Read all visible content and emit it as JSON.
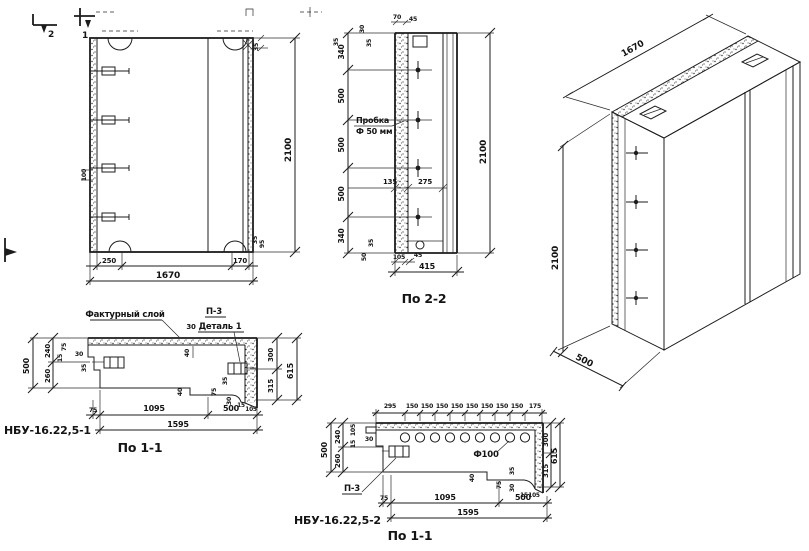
{
  "colors": {
    "ink": "#1c1c1c",
    "paper": "#ffffff"
  },
  "elevation": {
    "cut_marks": [
      "2",
      "1"
    ],
    "dim_top": "35",
    "dim_anchor": "100",
    "side_small": [
      "35",
      "95"
    ],
    "height": "2100",
    "bottom_left": "250",
    "bottom_right": "170",
    "bottom_total": "1670"
  },
  "section_2_2": {
    "label": "По 2-2",
    "plug_label": [
      "Пробка",
      "Ф 50 мм"
    ],
    "top_small": [
      "70",
      "45"
    ],
    "side_small": [
      "30",
      "35"
    ],
    "left_chain": [
      "340",
      "500",
      "500",
      "500",
      "340"
    ],
    "edge_top": "35",
    "edge_bottom": "35",
    "edge_50": "50",
    "mid": [
      "135",
      "275"
    ],
    "bottom_small": [
      "105",
      "45"
    ],
    "width_total": "415",
    "height": "2100"
  },
  "isometric": {
    "length": "1670",
    "height": "2100",
    "depth": "500"
  },
  "section_a": {
    "mark": "НБУ-16.22,5-1",
    "label": "По 1-1",
    "facing_label": "Фактурный слой",
    "p3": "П-3",
    "detail": "Деталь 1",
    "dim_30": "30",
    "dim_40": "40",
    "left_total": "500",
    "left_top": "240",
    "left_bottom": "260",
    "left_small": [
      "75",
      "15",
      "30",
      "35"
    ],
    "right_top": "300",
    "right_bottom": "315",
    "right_total": "615",
    "bottom_75": "75",
    "bottom_1095": "1095",
    "bottom_500": "500",
    "bottom_total": "1595",
    "bottom_small": [
      "40",
      "75",
      "35",
      "30",
      "15",
      "105"
    ]
  },
  "section_b": {
    "mark": "НБУ-16.22,5-2",
    "label": "По 1-1",
    "p3": "П-3",
    "hole": "Ф100",
    "top_chain": [
      "295",
      "150",
      "150",
      "150",
      "150",
      "150",
      "150",
      "150",
      "150",
      "175"
    ],
    "left_total": "500",
    "left_top": "240",
    "left_bottom": "260",
    "left_small": [
      "105",
      "15",
      "30"
    ],
    "right_top": "300",
    "right_bottom": "315",
    "right_total": "615",
    "bottom_75": "75",
    "bottom_1095": "1095",
    "bottom_500": "500",
    "bottom_total": "1595",
    "bottom_small": [
      "40",
      "75",
      "35",
      "30",
      "15",
      "105"
    ]
  }
}
